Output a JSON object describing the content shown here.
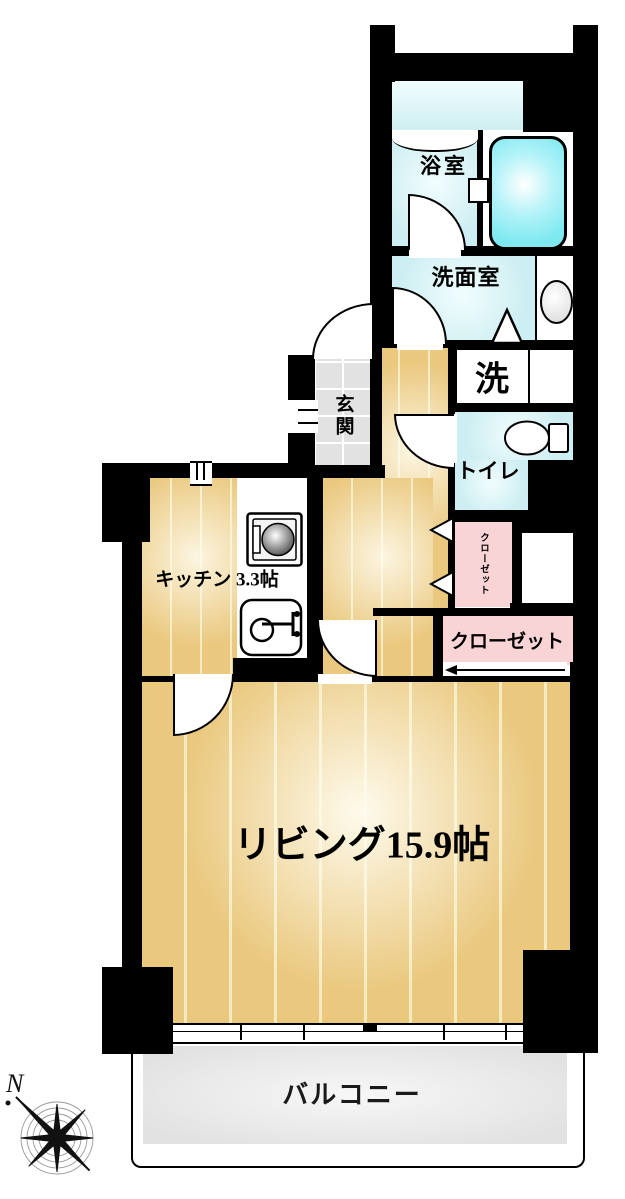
{
  "floorplan": {
    "type": "japanese-apartment-floorplan",
    "rooms": {
      "bathroom": {
        "label": "浴室"
      },
      "washroom": {
        "label": "洗面室"
      },
      "laundry": {
        "label": "洗"
      },
      "toilet": {
        "label": "トイレ"
      },
      "entrance": {
        "label": "玄関"
      },
      "kitchen": {
        "label": "キッチン 3.3帖"
      },
      "closet_hall": {
        "label": "クローゼット"
      },
      "closet_living": {
        "label": "クローゼット"
      },
      "living": {
        "label": "リビング15.9帖"
      },
      "balcony": {
        "label": "バルコニー"
      }
    },
    "compass": {
      "north": "N",
      "direction": "north-up-left"
    },
    "fixtures": [
      "bathtub-icon",
      "washbasin-icon",
      "toilet-icon",
      "stove-icon",
      "kitchen-sink-icon",
      "folding-door-icon",
      "sliding-door-arrow-icon",
      "compass-rose-icon"
    ],
    "colors": {
      "wall": "#000000",
      "wood_floor": "#eac87e",
      "wood_plank_line": "#f6ebc0",
      "wet_room": "#cdeef2",
      "bathtub": "#7fe9f1",
      "closet": "#f9d4d6",
      "entrance_tile": "#e2e2e2",
      "balcony_floor": "#ececec"
    }
  }
}
